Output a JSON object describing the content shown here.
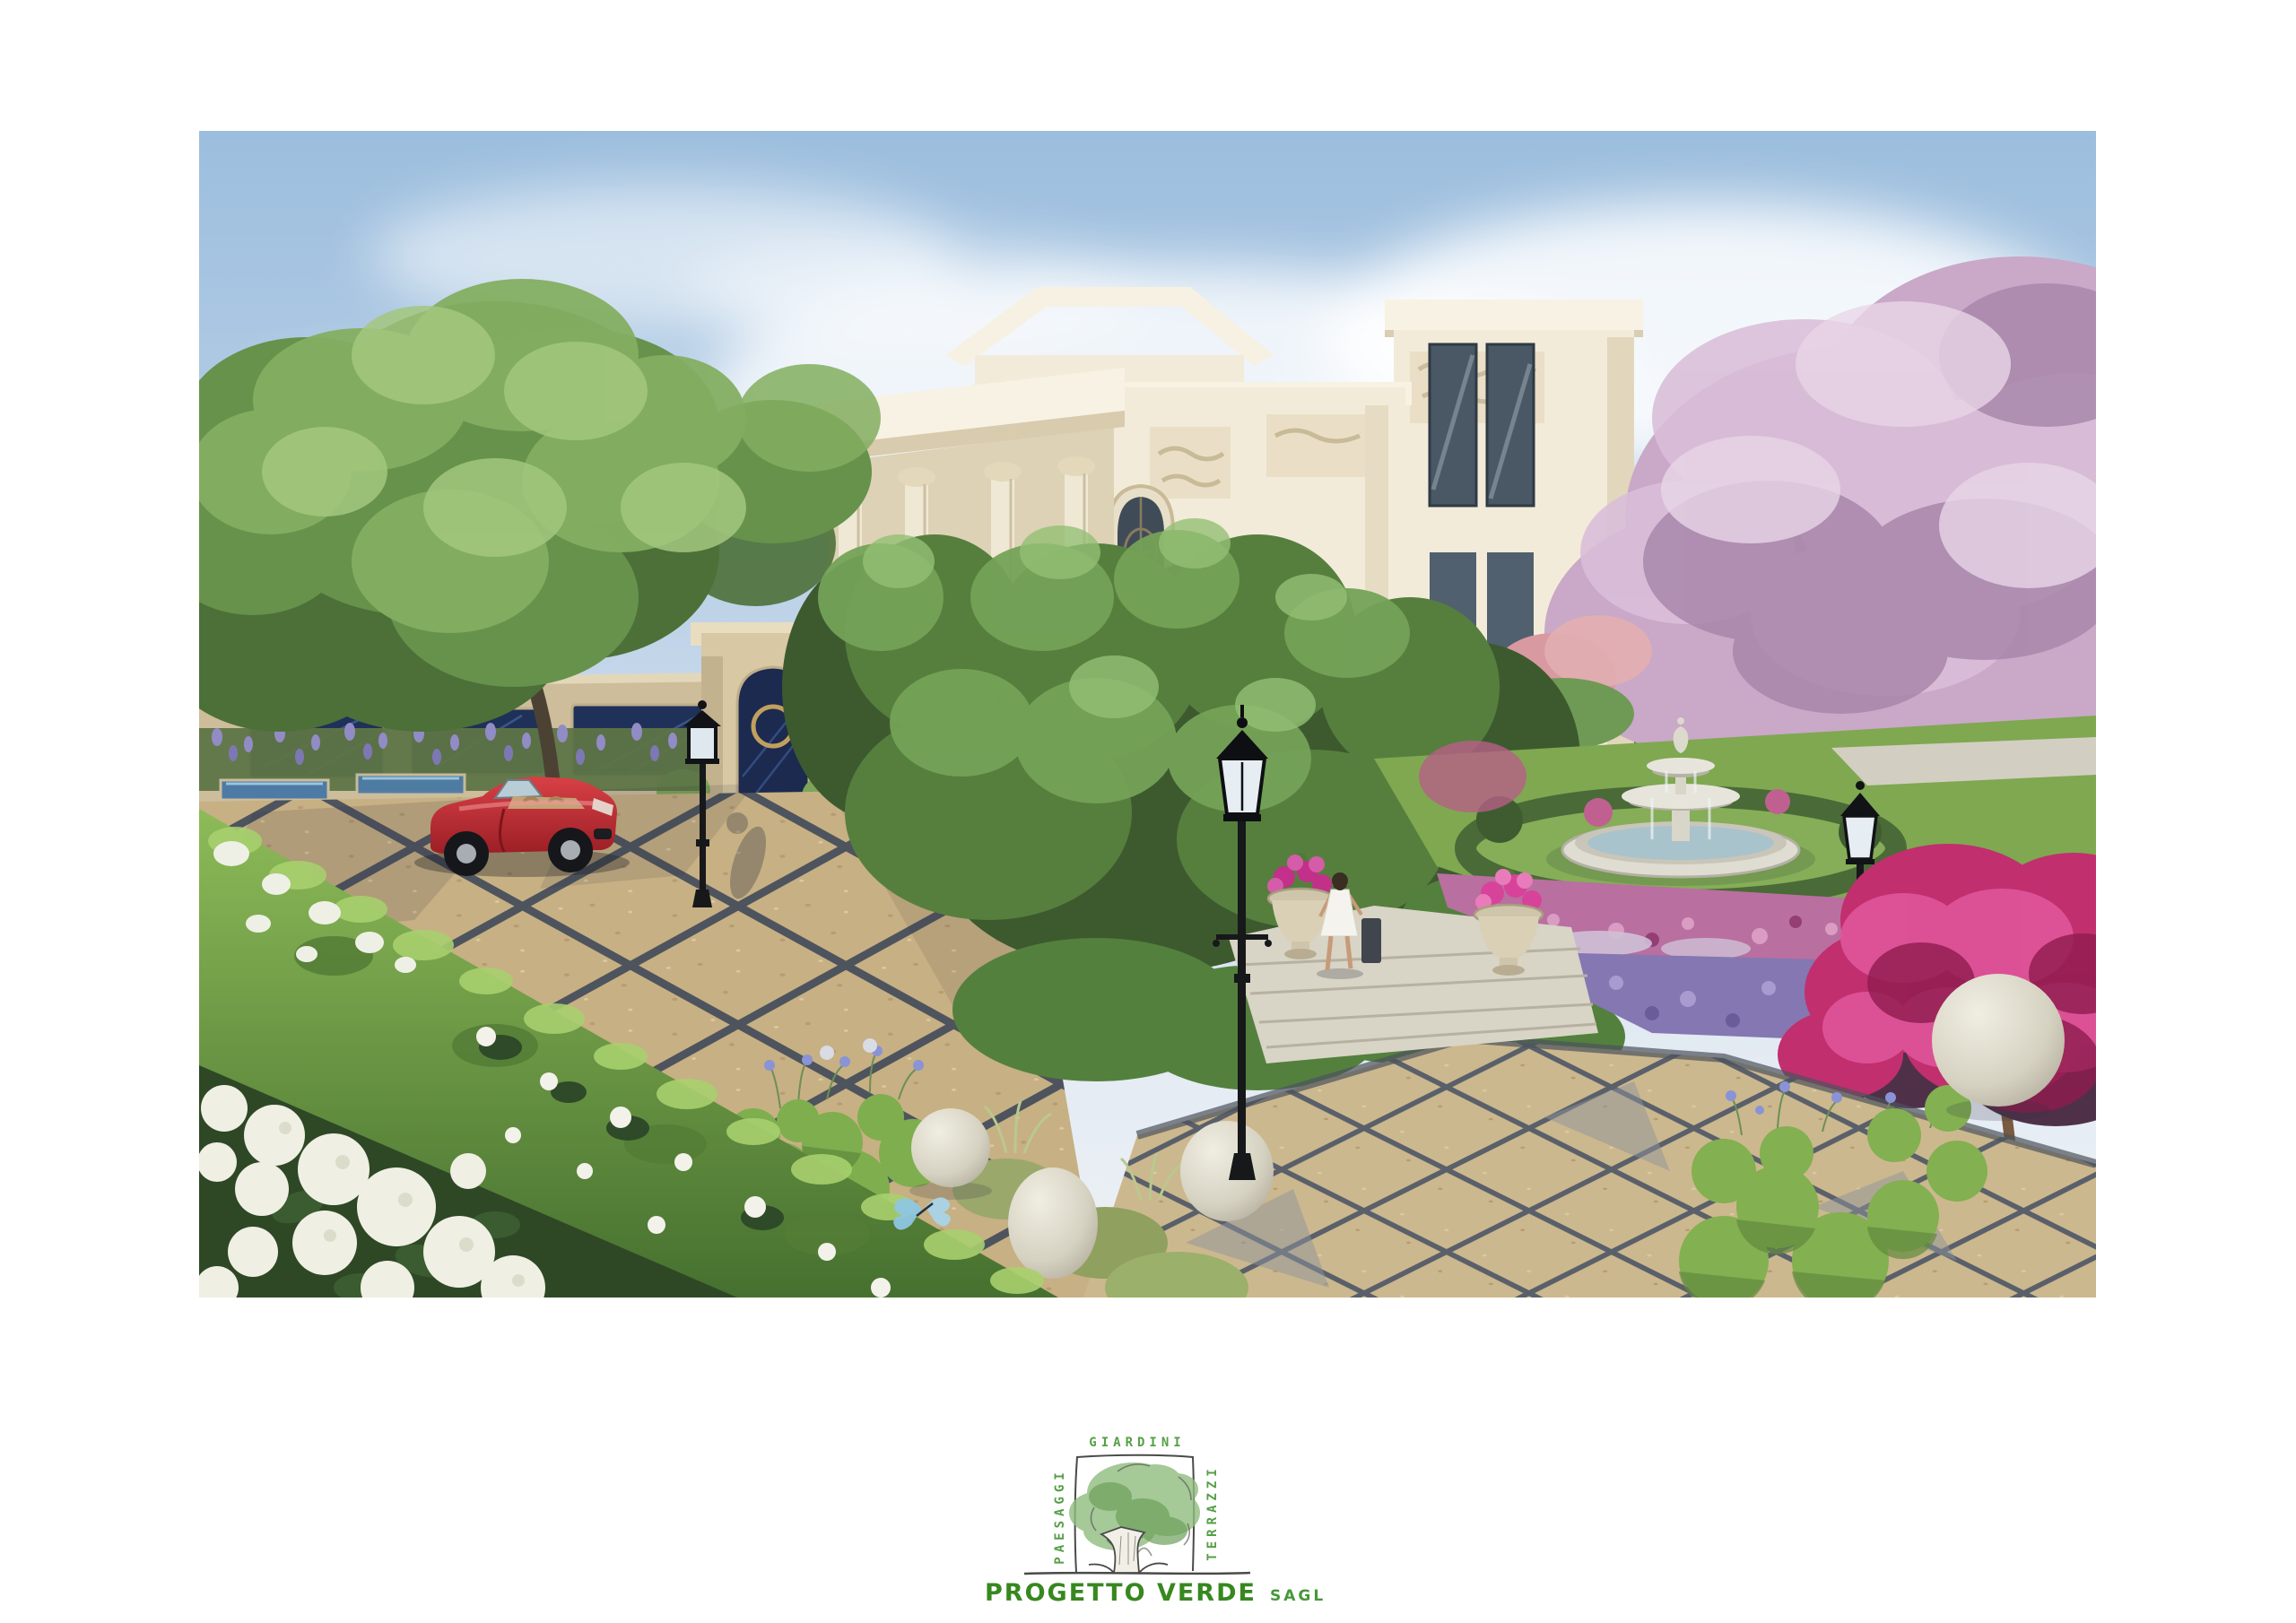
{
  "page": {
    "background": "#ffffff"
  },
  "artwork": {
    "kind": "architectural landscape rendering",
    "scene_elements": [
      "classical villa with corinthian portico",
      "flying birds",
      "large plane tree",
      "boundary wall with blue marble panels",
      "entrance gate with gold ring door",
      "red convertible sports car",
      "diamond-pattern pebble driveway",
      "victorian street lamps",
      "tiered stone fountain in hedge ring",
      "cherry blossom trees",
      "magenta bougainvillea tree",
      "pink and purple flower beds",
      "topiary balls",
      "stone spheres",
      "agapanthus flowers",
      "flower urns with pink petunias",
      "woman in white dress",
      "steps",
      "foreground hedge with white gardenias",
      "white hydrangea bed",
      "blue butterfly"
    ],
    "palette": {
      "sky": "#9cbede",
      "cloud": "#ffffff",
      "villa_cream": "#f2ebd9",
      "villa_shadow": "#ddd0b4",
      "cornice": "#f7f2e3",
      "window_glass": "#4a5866",
      "foliage_dark": "#3d5a2f",
      "foliage_mid": "#567f3e",
      "foliage_light": "#84ae61",
      "hedge_bright": "#8dbb58",
      "lawn": "#7fa851",
      "blossom_pink": "#c9a8c8",
      "bougainvillea": "#c12f6e",
      "bed_pink": "#b96fa0",
      "bed_purple": "#8577b2",
      "lavender": "#8b86c0",
      "agapanthus": "#8a93d6",
      "hydrangea": "#f0efe3",
      "paving_tan": "#c7b083",
      "paving_joint": "#4e545e",
      "car_red": "#c0282e",
      "lamp_black": "#17181a",
      "stone": "#d6d2c2",
      "marble_blue": "#1f3158",
      "gold": "#c1a05e"
    }
  },
  "logo": {
    "top_label": "GIARDINI",
    "left_label": "PAESAGGI",
    "right_label": "TERRAZZI",
    "company": "PROGETTO VERDE",
    "suffix": "SAGL",
    "label_color": "#569f47",
    "company_color": "#37881f",
    "line_color": "#4a4a4a",
    "tree_green": "#8fbc7e"
  }
}
